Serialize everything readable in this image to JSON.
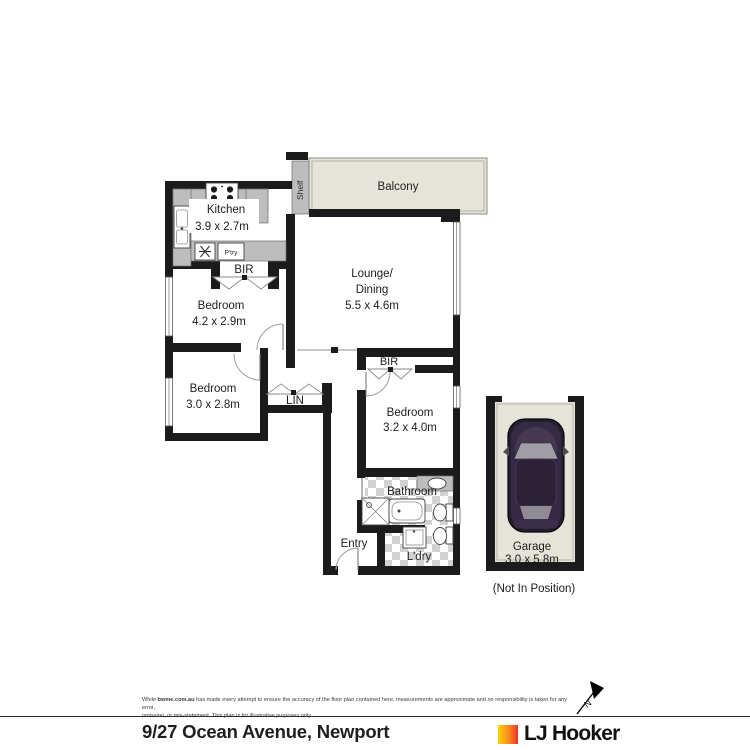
{
  "plan": {
    "balcony": {
      "label": "Balcony"
    },
    "shelf": {
      "label": "Shelf"
    },
    "kitchen": {
      "label": "Kitchen",
      "dims": "3.9 x 2.7m"
    },
    "pantry": {
      "label": "P'try"
    },
    "bir_bedroom1": {
      "label": "BIR"
    },
    "lounge": {
      "line1": "Lounge/",
      "line2": "Dining",
      "dims": "5.5 x 4.6m"
    },
    "bedroom1": {
      "label": "Bedroom",
      "dims": "4.2 x 2.9m"
    },
    "bedroom2": {
      "label": "Bedroom",
      "dims": "3.0 x 2.8m"
    },
    "linen": {
      "label": "LIN"
    },
    "bir_bedroom3": {
      "label": "BIR"
    },
    "bedroom3": {
      "label": "Bedroom",
      "dims": "3.2 x 4.0m"
    },
    "bathroom": {
      "label": "Bathroom"
    },
    "entry": {
      "label": "Entry"
    },
    "laundry": {
      "label": "L'dry"
    },
    "garage": {
      "label": "Garage",
      "dims": "3.0 x 5.8m",
      "note": "(Not In Position)"
    }
  },
  "compass": {
    "north_label": "N"
  },
  "footer": {
    "disclaimer_prefix": "While ",
    "disclaimer_site": "bwme.com.au",
    "disclaimer_line1": " has made every attempt to ensure the accuracy of the floor plan contained here, measurements are approximate and no responsibility is taken for any error,",
    "disclaimer_line2": "omission, or mis-statement. This plan is for illustrative purposes only.",
    "address": "9/27 Ocean Avenue, Newport",
    "brand": "LJ Hooker"
  },
  "colors": {
    "wall": "#1b1b1b",
    "balcony_floor": "#e6e4d9",
    "counter_grey": "#bdbdbd",
    "tile_grey": "#d2d2d2",
    "car_body": "#261d31",
    "brand_yellow": "#ffd100",
    "brand_orange": "#f68b1f",
    "brand_red": "#ee3124"
  }
}
